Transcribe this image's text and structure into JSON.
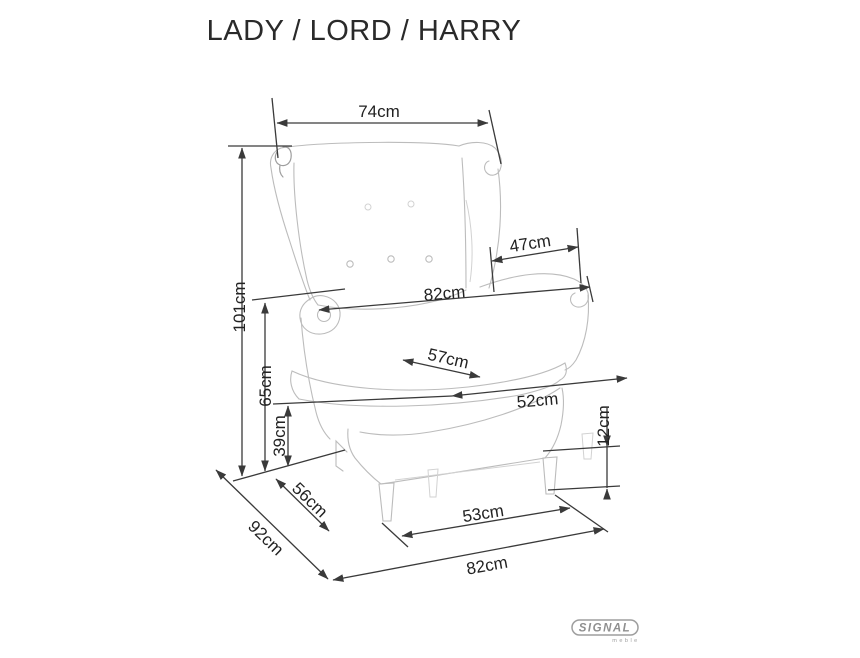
{
  "title": "LADY / LORD / HARRY",
  "logo": {
    "brand": "SIGNAL",
    "sub": "meble"
  },
  "colors": {
    "background": "#ffffff",
    "dimension_lines": "#3a3a3a",
    "dimension_text": "#222222",
    "chair_sketch": "#bcbcbc",
    "logo_gray": "#9e9e9e"
  },
  "dimensions": [
    {
      "id": "top-width",
      "label": "74cm"
    },
    {
      "id": "total-height",
      "label": "101cm"
    },
    {
      "id": "armrest-length",
      "label": "47cm"
    },
    {
      "id": "width-at-arms",
      "label": "82cm"
    },
    {
      "id": "seat-width",
      "label": "57cm"
    },
    {
      "id": "seat-depth",
      "label": "52cm"
    },
    {
      "id": "armrest-height",
      "label": "65cm"
    },
    {
      "id": "seat-height",
      "label": "39cm"
    },
    {
      "id": "leg-height",
      "label": "12cm"
    },
    {
      "id": "inner-depth",
      "label": "56cm"
    },
    {
      "id": "total-depth",
      "label": "92cm"
    },
    {
      "id": "front-leg-span",
      "label": "53cm"
    },
    {
      "id": "base-width",
      "label": "82cm"
    }
  ]
}
